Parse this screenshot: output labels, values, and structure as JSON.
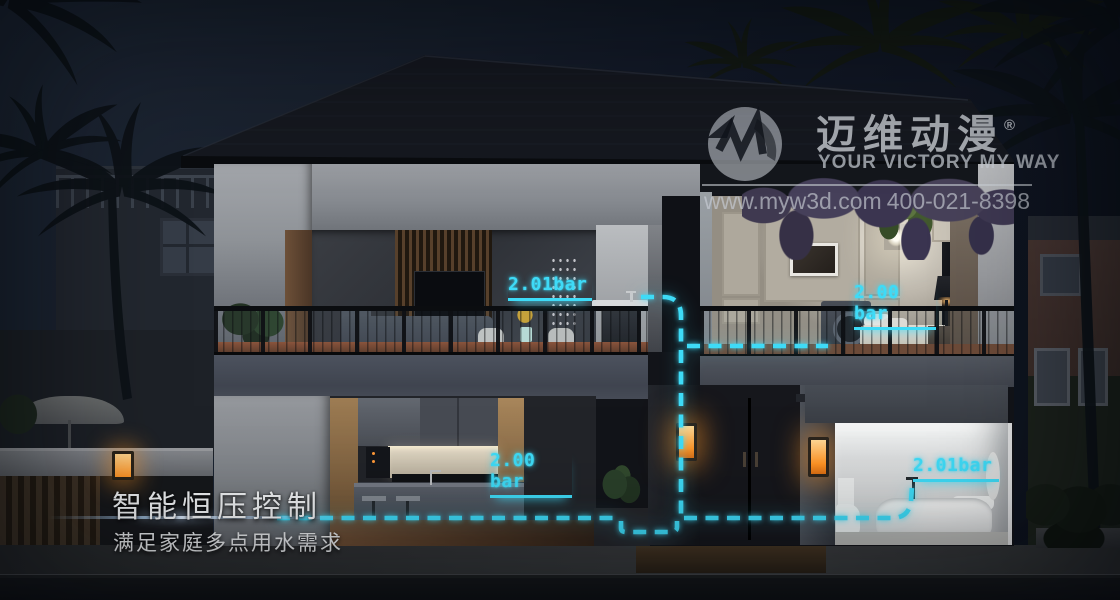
{
  "watermark": {
    "logo_text": "迈维动漫",
    "registered_mark": "®",
    "tagline": "YOUR VICTORY MY WAY",
    "website": "www.myw3d.com",
    "phone": "400-021-8398"
  },
  "caption": {
    "title": "智能恒压控制",
    "subtitle": "满足家庭多点用水需求"
  },
  "pressure": {
    "unit": "bar",
    "labels": [
      {
        "location": "second-floor-basin",
        "value": "2.01bar"
      },
      {
        "location": "second-floor-bedroom",
        "value": "2.00 bar"
      },
      {
        "location": "kitchen",
        "value": "2.00 bar"
      },
      {
        "location": "bathroom-bathtub",
        "value": "2.01bar"
      }
    ]
  },
  "colors": {
    "pipe_cyan": "#3edbf7",
    "lamp_amber": "#ffa63c",
    "sky_dark": "#141b27"
  }
}
